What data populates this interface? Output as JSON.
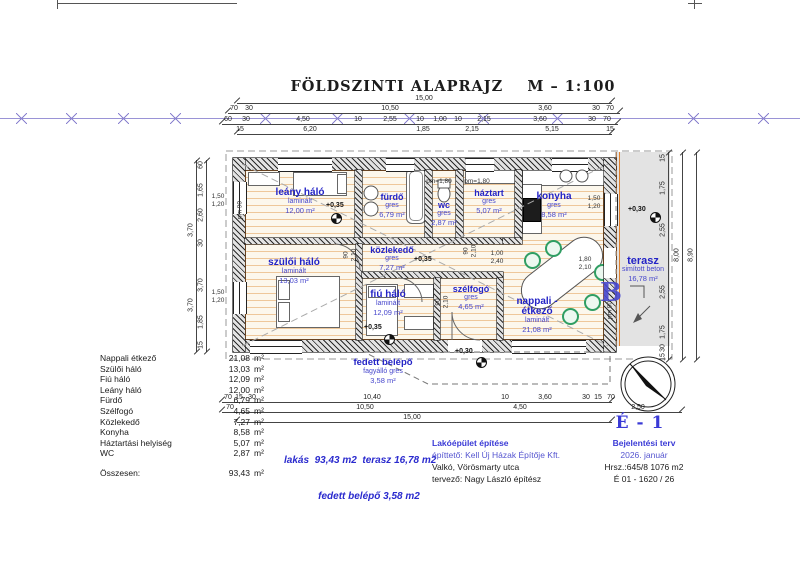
{
  "title": "FÖLDSZINTI ALAPRAJZ    M – 1:100",
  "rooms": [
    {
      "name": "leány háló",
      "material": "laminált",
      "area": "12,00 m²"
    },
    {
      "name": "fürdő",
      "material": "gres",
      "area": "6,79 m²"
    },
    {
      "name": "wc",
      "material": "gres",
      "area": "2,87 m²"
    },
    {
      "name": "háztart",
      "material": "gres",
      "area": "5,07 m²"
    },
    {
      "name": "konyha",
      "material": "gres",
      "area": "8,58 m²"
    },
    {
      "name": "szülői háló",
      "material": "laminált",
      "area": "13,03 m²"
    },
    {
      "name": "közlekedő",
      "material": "gres",
      "area": "7,27 m²"
    },
    {
      "name": "fiú háló",
      "material": "laminált",
      "area": "12,09 m²"
    },
    {
      "name": "szélfogó",
      "material": "gres",
      "area": "4,65 m²"
    },
    {
      "name": "nappali - étkező",
      "material": "laminált",
      "area": "21,08 m²"
    },
    {
      "name": "terasz",
      "material": "simított beton",
      "area": "16,78 m²"
    },
    {
      "name": "fedett belépő",
      "material": "fagyálló gres",
      "area": "3,58 m²"
    }
  ],
  "levels": {
    "leany": "+0,35",
    "kozlekedo": "+0,35",
    "fiu": "+0,35",
    "terasz": "+0,30",
    "belepo": "+0,30"
  },
  "section_marker": "B",
  "dims": {
    "top1": [
      "15,00"
    ],
    "top2": [
      "70",
      "30",
      "10,50",
      "3,60",
      "30",
      "70"
    ],
    "top3": [
      "60",
      "30",
      "4,50",
      "10",
      "2,55",
      "10",
      "1,00",
      "10",
      "2,15",
      "3,60",
      "30",
      "70"
    ],
    "top4": [
      "15",
      "6,20",
      "1,85",
      "2,15",
      "5,15",
      "15"
    ],
    "bottom1": [
      "70",
      "15",
      "30",
      "10,40",
      "10",
      "3,60",
      "30",
      "15",
      "70"
    ],
    "bottom2": [
      "70",
      "10,50",
      "4,50",
      "2,50"
    ],
    "bottom3": [
      "15,00"
    ],
    "left1": [
      "60",
      "1,65",
      "2,60",
      "30",
      "3,70",
      "1,85",
      "15"
    ],
    "left2": [
      "3,70",
      "3,70"
    ],
    "right1": [
      "15",
      "1,75",
      "2,55",
      "2,55",
      "1,75",
      "30",
      "15"
    ],
    "right2": [
      "8,00"
    ],
    "right3": [
      "8,90"
    ],
    "win_left": [
      "1,50",
      "1,20",
      "1,50",
      "1,20"
    ],
    "win_right": [
      "1,50",
      "1,20",
      "1,80",
      "2,10"
    ],
    "pm": [
      "pm=1,80",
      "pm=1,80",
      "pm  90",
      "pm  90"
    ],
    "doors": [
      "90",
      "2,10",
      "90",
      "2,10",
      "90",
      "2,10"
    ],
    "table_size": [
      "1,00",
      "2,40"
    ]
  },
  "area_table": {
    "rows": [
      {
        "label": "Nappali étkező",
        "value": "21,08",
        "unit": "m²"
      },
      {
        "label": "Szülői háló",
        "value": "13,03",
        "unit": "m²"
      },
      {
        "label": "Fiú háló",
        "value": "12,09",
        "unit": "m²"
      },
      {
        "label": "Leány háló",
        "value": "12,00",
        "unit": "m²"
      },
      {
        "label": "Fürdő",
        "value": "6,79",
        "unit": "m²"
      },
      {
        "label": "Szélfogó",
        "value": "4,65",
        "unit": "m²"
      },
      {
        "label": "Közlekedő",
        "value": "7,27",
        "unit": "m²"
      },
      {
        "label": "Konyha",
        "value": "8,58",
        "unit": "m²"
      },
      {
        "label": "Háztartási helyiség",
        "value": "5,07",
        "unit": "m²"
      },
      {
        "label": "WC",
        "value": "2,87",
        "unit": "m²"
      }
    ],
    "total": {
      "label": "Összesen:",
      "value": "93,43",
      "unit": "m²"
    }
  },
  "summary": {
    "line1": "lakás  93,43 m2  terasz 16,78 m2",
    "line2": "fedett belépő 3,58 m2"
  },
  "titleblock": {
    "project": "Lakóépület építése",
    "client": "építtető: Kell Új Házak Építője Kft.",
    "address": "Valkó, Vörösmarty utca",
    "designer": "tervező:  Nagy László  építész",
    "doc_type": "Bejelentési terv",
    "date": "2026. január",
    "parcel": "Hrsz.:645/8  1076 m2",
    "ref": "É 01 - 1620 / 26",
    "sheet_no": "É - 1"
  }
}
